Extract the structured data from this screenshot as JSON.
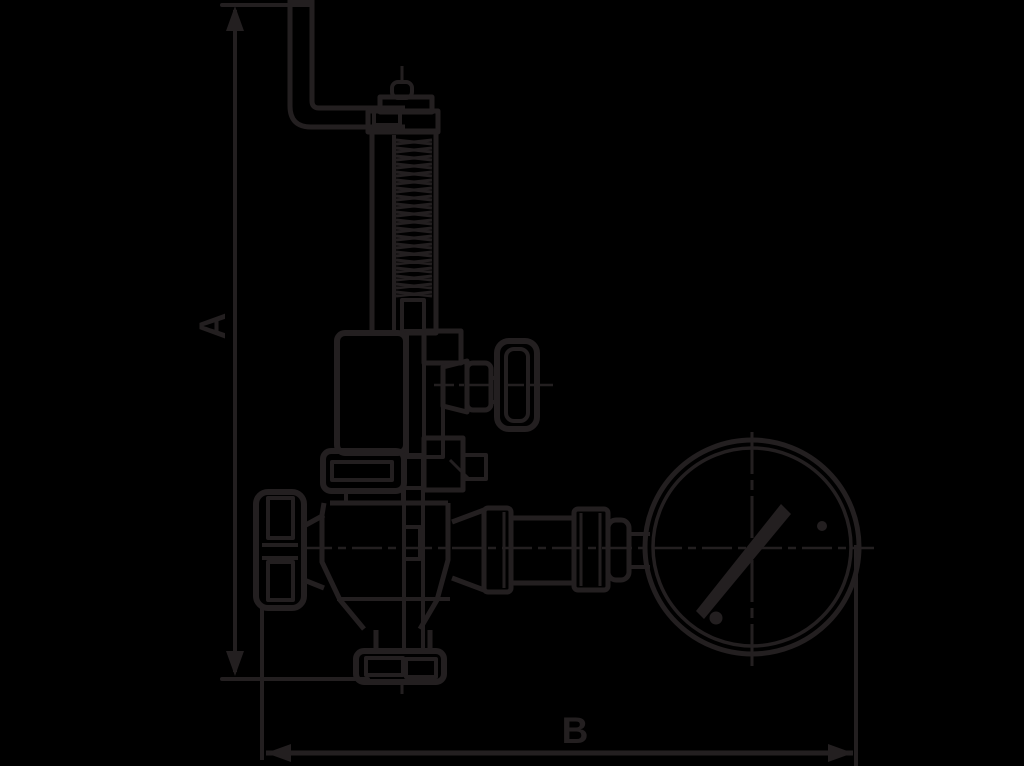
{
  "canvas": {
    "width": 1024,
    "height": 766,
    "background_color": "#000000",
    "line_color": "#231f20"
  },
  "drawing": {
    "type": "technical-line-drawing",
    "subject": "safety-relief-valve-with-test-lever-handwheel-and-pressure-gauge-side-elevation",
    "dimensions": {
      "a_label": "A",
      "b_label": "B"
    },
    "parts": [
      "test-lever",
      "lifting-pin-cap",
      "spring-column",
      "bonnet",
      "side-outlet-knob",
      "union-nut",
      "lower-body",
      "handwheel",
      "gauge-connection-fittings",
      "pressure-gauge",
      "inlet-hex-connector"
    ]
  }
}
